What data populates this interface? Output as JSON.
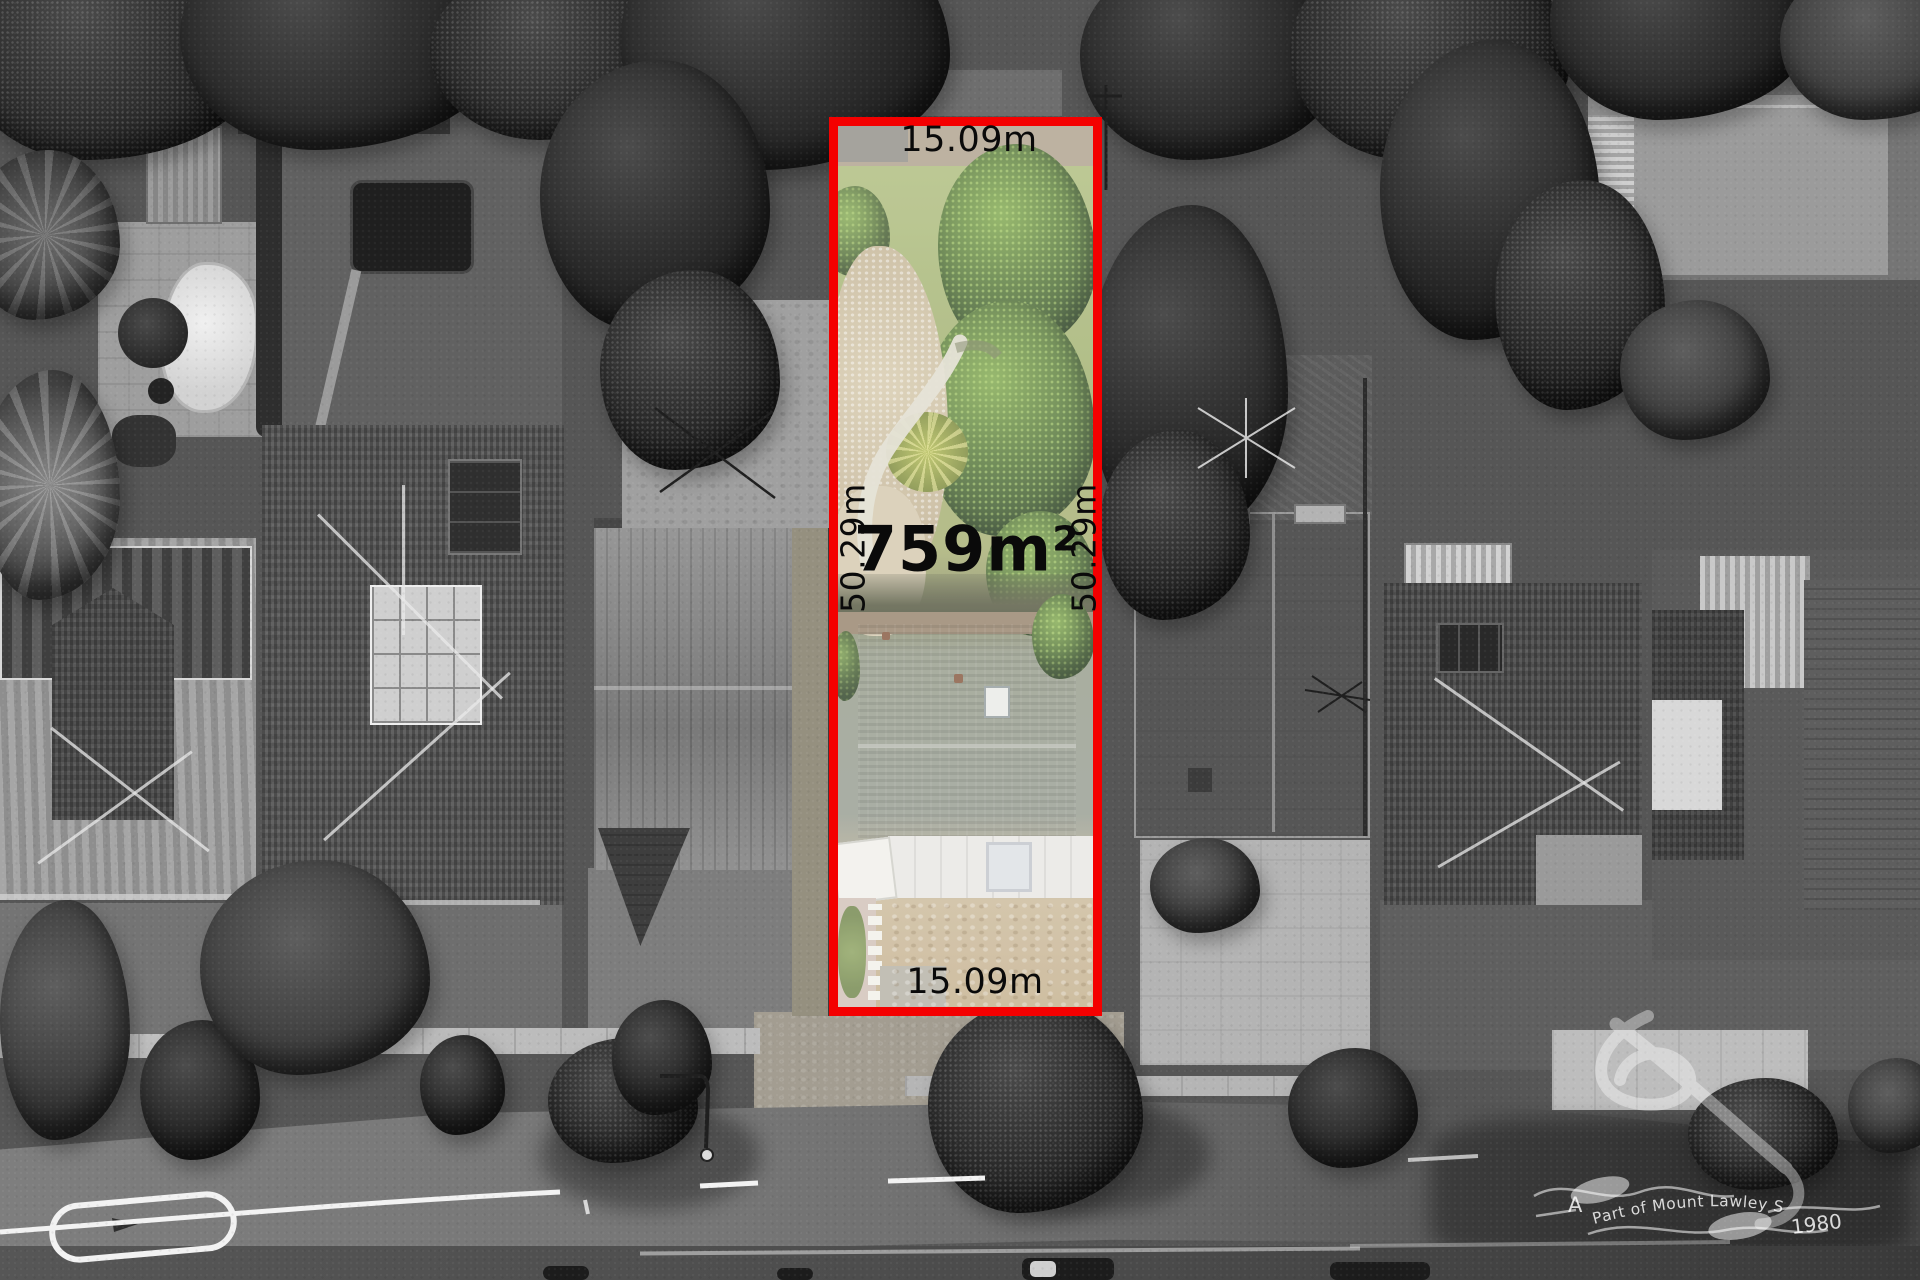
{
  "meta": {
    "type": "aerial-property-marketing-photo"
  },
  "colors": {
    "boundary": "#f40000",
    "label": "#0a0a0a",
    "watermark": "#ffffff"
  },
  "lot": {
    "area": "759m²",
    "frontage_top": "15.09m",
    "frontage_bottom": "15.09m",
    "depth_left": "50.29m",
    "depth_right": "50.29m"
  },
  "watermark": {
    "lead": "A",
    "arc": "Part of Mount Lawley Since",
    "year": "1980"
  }
}
